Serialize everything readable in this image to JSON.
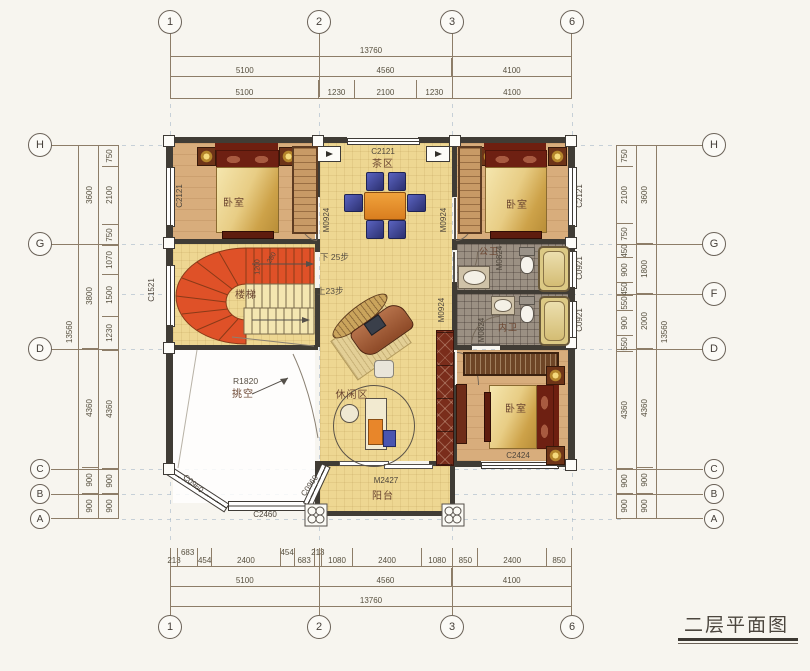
{
  "title": "二层平面图",
  "axes": {
    "cols": [
      "1",
      "2",
      "3",
      "6"
    ],
    "left_rows": [
      "H",
      "G",
      "D",
      "C",
      "B",
      "A"
    ],
    "right_rows": [
      "H",
      "G",
      "F",
      "D",
      "C",
      "B",
      "A"
    ]
  },
  "dims": {
    "top": {
      "r1": [
        "13760"
      ],
      "r2": [
        "5100",
        "4560",
        "4100"
      ],
      "r3": [
        "5100",
        "1230",
        "2100",
        "1230",
        "4100"
      ]
    },
    "bottom": {
      "r1": [
        "213",
        "683",
        "454",
        "2400",
        "454",
        "683",
        "213",
        "1080",
        "2400",
        "1080",
        "850",
        "2400",
        "850"
      ],
      "r2": [
        "5100",
        "4560",
        "4100"
      ],
      "r3": [
        "13760"
      ]
    },
    "left": {
      "outer": [
        "13560"
      ],
      "mid": [
        "3600",
        "3800",
        "4360",
        "900",
        "900"
      ],
      "inner": [
        "750",
        "2100",
        "750",
        "1070",
        "1500",
        "1230",
        "4360",
        "900",
        "900"
      ]
    },
    "right": {
      "inner": [
        "750",
        "2100",
        "750",
        "450",
        "900",
        "450",
        "550",
        "900",
        "550",
        "4360",
        "900",
        "900"
      ],
      "mid": [
        "3600",
        "1800",
        "2000",
        "4360",
        "900",
        "900"
      ],
      "outer": [
        "13560"
      ]
    }
  },
  "rooms": {
    "bedroom_tl": "卧室",
    "tea_area": "茶区",
    "bedroom_tr": "卧室",
    "stairs": "楼梯",
    "bath_public": "公卫",
    "bath_private": "内卫",
    "lounge": "休闲区",
    "void": "挑空",
    "balcony": "阳台",
    "bedroom_br": "卧室"
  },
  "openings": {
    "window_tl": "C2121",
    "window_top": "C2121",
    "window_tr": "C2121",
    "window_stair": "C1521",
    "window_bath1": "C0921",
    "window_bath2": "C0921",
    "window_br": "C2424",
    "bay_left": "C0960",
    "bay_center": "C2460",
    "bay_right": "C0960",
    "door_tl": "M0924",
    "door_tr": "M0924",
    "door_hall": "M0924",
    "door_bath1": "M0824",
    "door_bath2": "M0824",
    "door_balcony": "M2427"
  },
  "notes": {
    "down_steps": "下 25步",
    "up_steps": "上23步",
    "void_radius": "R1820",
    "stair_width": "1200",
    "stair_tread": "280"
  }
}
